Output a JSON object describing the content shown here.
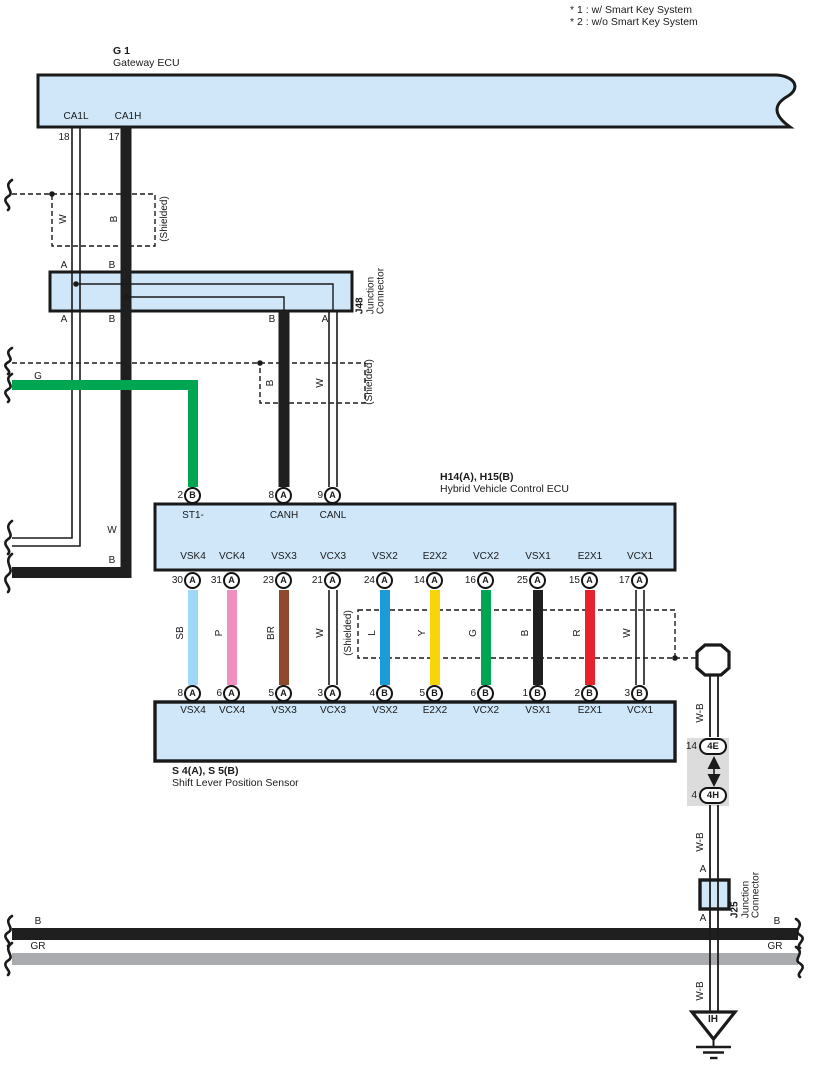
{
  "diagram_notes": {
    "note1": "* 1 : w/ Smart Key System",
    "note2": "* 2 : w/o Smart Key System"
  },
  "shield_label": "(Shielded)",
  "gateway_ecu": {
    "code": "G 1",
    "name": "Gateway ECU",
    "pins": [
      {
        "name": "CA1L",
        "num": "18"
      },
      {
        "name": "CA1H",
        "num": "17"
      }
    ]
  },
  "junction_j48": {
    "code": "J48",
    "name_line1": "Junction",
    "name_line2": "Connector",
    "top_pins": [
      "A",
      "B"
    ],
    "bottom_pins": [
      "A",
      "B",
      "B",
      "A"
    ]
  },
  "upper_wires": {
    "shield1_w": "W",
    "shield1_b": "B",
    "green": "G",
    "shield2_b": "B",
    "shield2_w": "W",
    "exit_w": "W",
    "exit_b": "B"
  },
  "hv_ecu": {
    "code": "H14(A), H15(B)",
    "name": "Hybrid Vehicle Control ECU",
    "top_pins": [
      {
        "num": "2",
        "letter": "B",
        "label": "ST1-"
      },
      {
        "num": "8",
        "letter": "A",
        "label": "CANH"
      },
      {
        "num": "9",
        "letter": "A",
        "label": "CANL"
      }
    ]
  },
  "bus": [
    {
      "ecu_pin": {
        "num": "30",
        "letter": "A",
        "label": "VSK4"
      },
      "sensor_pin": {
        "num": "8",
        "letter": "A",
        "label": "VSX4"
      },
      "wire": {
        "color": "SB",
        "hex": "#9ed8f5",
        "style": "solid"
      }
    },
    {
      "ecu_pin": {
        "num": "31",
        "letter": "A",
        "label": "VCK4"
      },
      "sensor_pin": {
        "num": "6",
        "letter": "A",
        "label": "VCX4"
      },
      "wire": {
        "color": "P",
        "hex": "#f18fc1",
        "style": "solid"
      }
    },
    {
      "ecu_pin": {
        "num": "23",
        "letter": "A",
        "label": "VSX3"
      },
      "sensor_pin": {
        "num": "5",
        "letter": "A",
        "label": "VSX3"
      },
      "wire": {
        "color": "BR",
        "hex": "#8d4a2c",
        "style": "solid"
      }
    },
    {
      "ecu_pin": {
        "num": "21",
        "letter": "A",
        "label": "VCX3"
      },
      "sensor_pin": {
        "num": "3",
        "letter": "A",
        "label": "VCX3"
      },
      "wire": {
        "color": "W",
        "hex": "#ffffff",
        "style": "double"
      }
    },
    {
      "ecu_pin": {
        "num": "24",
        "letter": "A",
        "label": "VSX2"
      },
      "sensor_pin": {
        "num": "4",
        "letter": "B",
        "label": "VSX2"
      },
      "wire": {
        "color": "L",
        "hex": "#1b9cd9",
        "style": "solid"
      }
    },
    {
      "ecu_pin": {
        "num": "14",
        "letter": "A",
        "label": "E2X2"
      },
      "sensor_pin": {
        "num": "5",
        "letter": "B",
        "label": "E2X2"
      },
      "wire": {
        "color": "Y",
        "hex": "#f6d60a",
        "style": "solid"
      }
    },
    {
      "ecu_pin": {
        "num": "16",
        "letter": "A",
        "label": "VCX2"
      },
      "sensor_pin": {
        "num": "6",
        "letter": "B",
        "label": "VCX2"
      },
      "wire": {
        "color": "G",
        "hex": "#00a551",
        "style": "solid"
      }
    },
    {
      "ecu_pin": {
        "num": "25",
        "letter": "A",
        "label": "VSX1"
      },
      "sensor_pin": {
        "num": "1",
        "letter": "B",
        "label": "VSX1"
      },
      "wire": {
        "color": "B",
        "hex": "#1f1f1f",
        "style": "solid"
      }
    },
    {
      "ecu_pin": {
        "num": "15",
        "letter": "A",
        "label": "E2X1"
      },
      "sensor_pin": {
        "num": "2",
        "letter": "B",
        "label": "E2X1"
      },
      "wire": {
        "color": "R",
        "hex": "#e8222d",
        "style": "solid"
      }
    },
    {
      "ecu_pin": {
        "num": "17",
        "letter": "A",
        "label": "VCX1"
      },
      "sensor_pin": {
        "num": "3",
        "letter": "B",
        "label": "VCX1"
      },
      "wire": {
        "color": "W",
        "hex": "#ffffff",
        "style": "double"
      }
    }
  ],
  "shift_sensor": {
    "code": "S 4(A), S 5(B)",
    "name": "Shift Lever Position Sensor"
  },
  "shield_drain": {
    "wire_label": "W-B"
  },
  "inline_connector": {
    "top": {
      "num": "14",
      "code": "4E"
    },
    "bottom": {
      "num": "4",
      "code": "4H"
    }
  },
  "junction_j25": {
    "code": "J25",
    "name_line1": "Junction",
    "name_line2": "Connector",
    "top_pin": "A",
    "bottom_pin": "A"
  },
  "ground": {
    "code": "IH"
  },
  "bottom_bus": {
    "b_left": "B",
    "b_right": "B",
    "gr_left": "GR",
    "gr_right": "GR"
  },
  "colors": {
    "box_fill": "#cfe7f8",
    "outline": "#1a1a1a",
    "black_wire": "#1f1f1f",
    "gray_wire": "#a9abae",
    "connector_gray": "#dcdcdc"
  }
}
